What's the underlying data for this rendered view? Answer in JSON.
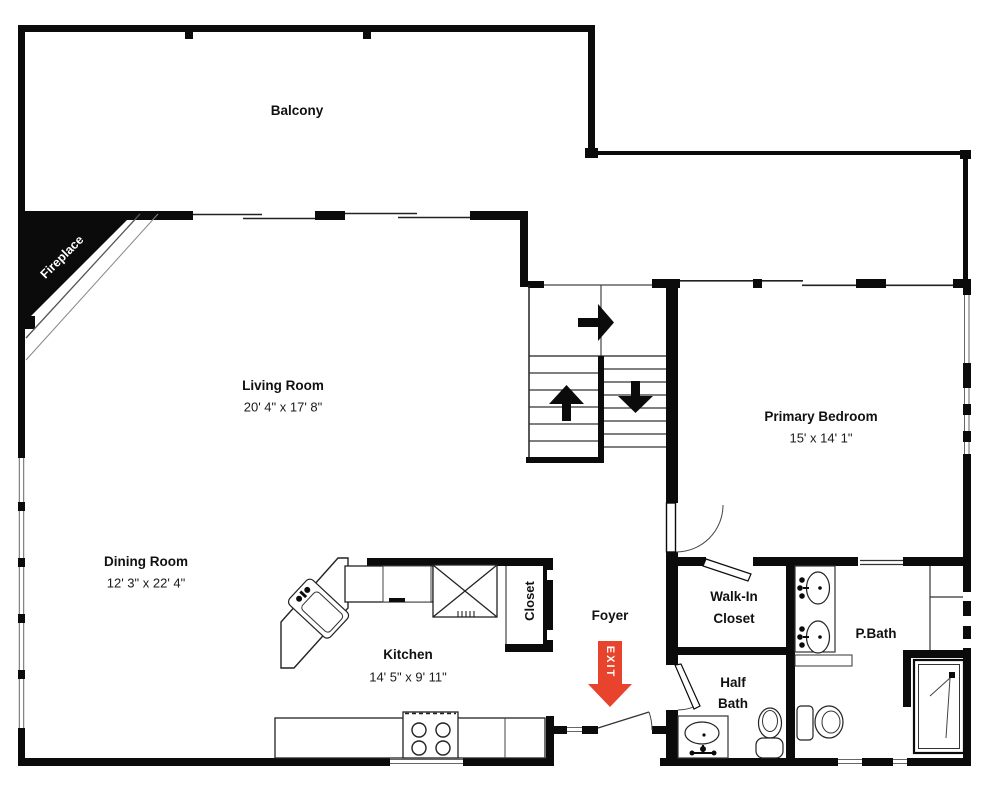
{
  "plan": {
    "title": "Floor plan",
    "wall_color": "#0b0b0b",
    "accent_color": "#e8432c",
    "background": "#ffffff"
  },
  "labels": {
    "balcony": "Balcony",
    "living": {
      "name": "Living Room",
      "dims": "20' 4\" x 17' 8\""
    },
    "dining": {
      "name": "Dining Room",
      "dims": "12' 3\" x 22' 4\""
    },
    "kitchen": {
      "name": "Kitchen",
      "dims": "14' 5\" x 9' 11\""
    },
    "primary_bedroom": {
      "name": "Primary Bedroom",
      "dims": "15' x 14' 1\""
    },
    "closet": "Closet",
    "foyer": "Foyer",
    "walk_in_closet": {
      "line1": "Walk-In",
      "line2": "Closet"
    },
    "half_bath": {
      "line1": "Half",
      "line2": "Bath"
    },
    "p_bath": "P.Bath",
    "fireplace": "Fireplace",
    "exit": "EXIT"
  }
}
